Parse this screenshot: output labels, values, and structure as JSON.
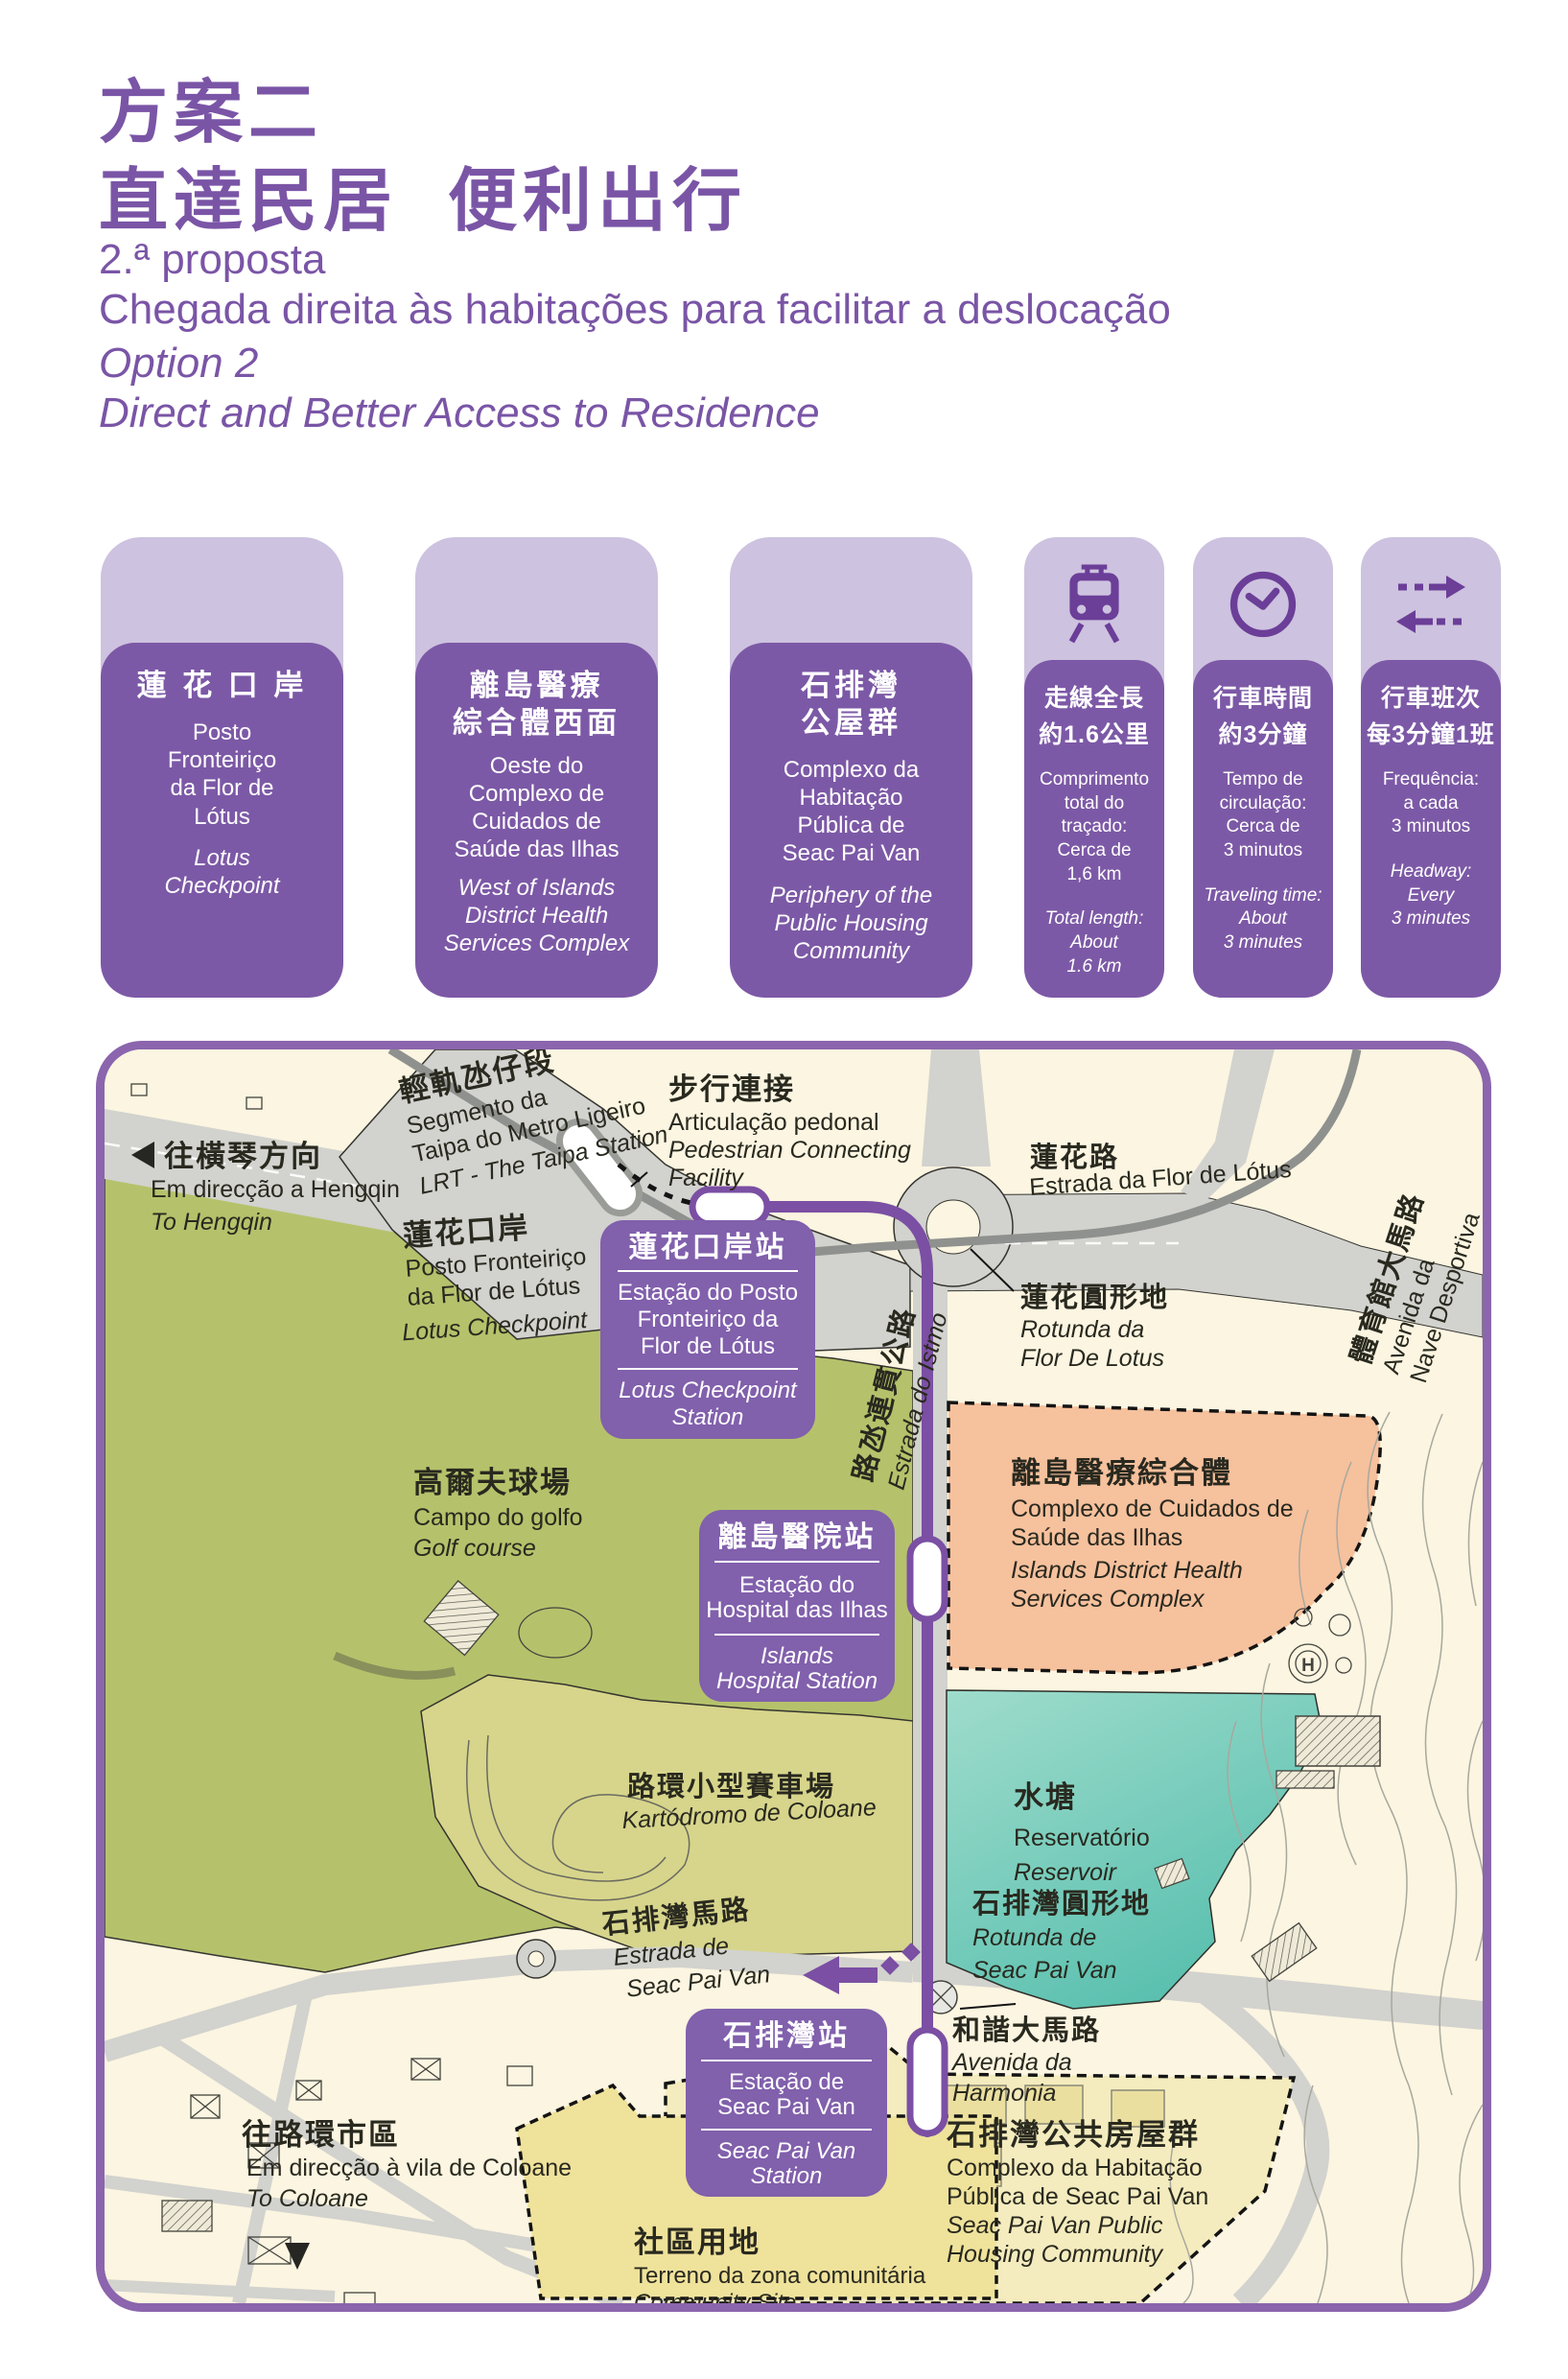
{
  "colors": {
    "accent": "#7A55A6",
    "card_light": "#CDC2DF",
    "card_dark": "#7C59A6",
    "node": "#6B3E98",
    "route": "#7B4FA3",
    "map_border": "#8B65AD",
    "map_bg": "#FBF5E1",
    "road": "#D2D2CE",
    "lrt": "#8F918E",
    "green": "#B5C26B",
    "kart": "#D7D58B",
    "orange": "#F6C19D",
    "teal": "#6FCBBB",
    "housing": "#F4ECBE",
    "community": "#EFE29B",
    "station_box": "#8160AC"
  },
  "header": {
    "title_zh_line1": "方案二",
    "title_zh_line2": "直達民居  便利出行",
    "subtitle_pt_line1": "2.ª proposta",
    "subtitle_pt_line2": "Chegada direita às habitações para facilitar a deslocação",
    "subtitle_en_line1": "Option 2",
    "subtitle_en_line2": "Direct and Better Access to Residence"
  },
  "stations": [
    {
      "zh": "蓮 花 口 岸",
      "pt": "Posto\nFronteiriço\nda Flor de\nLótus",
      "en": "Lotus\nCheckpoint"
    },
    {
      "zh": "離島醫療\n綜合體西面",
      "pt": "Oeste do\nComplexo de\nCuidados de\nSaúde das Ilhas",
      "en": "West of Islands\nDistrict Health\nServices Complex"
    },
    {
      "zh": "石排灣\n公屋群",
      "pt": "Complexo da\nHabitação\nPública de\nSeac Pai Van",
      "en": "Periphery of the\nPublic Housing\nCommunity"
    }
  ],
  "facts": [
    {
      "icon": "train-icon",
      "zh": "走線全長\n約1.6公里",
      "pt": "Comprimento\ntotal do traçado:\nCerca de\n1,6 km",
      "en": "Total length:\nAbout\n1.6 km"
    },
    {
      "icon": "clock-icon",
      "zh": "行車時間\n約3分鐘",
      "pt": "Tempo de\ncirculação:\nCerca de\n3 minutos",
      "en": "Traveling time:\nAbout\n3 minutes"
    },
    {
      "icon": "frequency-arrows-icon",
      "zh": "行車班次\n每3分鐘1班",
      "pt": "Frequência:\na cada\n3 minutos",
      "en": "Headway:\nEvery\n3 minutes"
    }
  ],
  "map": {
    "labels": {
      "direction_hengqin": {
        "zh": "往橫琴方向",
        "pt": "Em direcção a Hengqin",
        "en": "To Hengqin"
      },
      "lrt_segment": {
        "zh": "輕軌氹仔段",
        "pt": [
          "Segmento da",
          "Taipa do Metro Ligeiro"
        ],
        "en": "LRT - The Taipa Station"
      },
      "pedestrian_link": {
        "zh": "步行連接",
        "pt": "Articulação pedonal",
        "en": [
          "Pedestrian Connecting",
          "Facility"
        ]
      },
      "lotus_checkpoint": {
        "zh": "蓮花口岸",
        "pt": [
          "Posto Fronteiriço",
          "da Flor de Lótus"
        ],
        "en": "Lotus Checkpoint"
      },
      "estrada_flor_lotus": {
        "zh": "蓮花路",
        "pt": "Estrada da Flor de Lótus"
      },
      "rotunda_flor_lotus": {
        "zh": "蓮花圓形地",
        "pt": [
          "Rotunda da",
          "Flor De Lotus"
        ]
      },
      "nave_desportiva": {
        "zh": "體育館大馬路",
        "pt": [
          "Avenida da",
          "Nave Desportiva"
        ]
      },
      "estrada_istmo": {
        "zh": "路氹連貫公路",
        "pt": "Estrada do Istmo"
      },
      "health_complex": {
        "zh": "離島醫療綜合體",
        "pt": [
          "Complexo de Cuidados de",
          "Saúde das Ilhas"
        ],
        "en": [
          "Islands District Health",
          "Services Complex"
        ]
      },
      "golf": {
        "zh": "高爾夫球場",
        "pt": "Campo do golfo",
        "en": "Golf course"
      },
      "reservoir": {
        "zh": "水塘",
        "pt": "Reservatório",
        "en": "Reservoir"
      },
      "kart": {
        "zh": "路環小型賽車場",
        "pt": "Kartódromo de Coloane"
      },
      "estrada_seac_pai_van": {
        "zh": "石排灣馬路",
        "pt": [
          "Estrada de",
          "Seac Pai Van"
        ]
      },
      "rotunda_seac_pai_van": {
        "zh": "石排灣圓形地",
        "pt": [
          "Rotunda de",
          "Seac Pai Van"
        ]
      },
      "avenida_harmonia": {
        "zh": "和諧大馬路",
        "pt": [
          "Avenida da",
          "Harmonia"
        ]
      },
      "housing": {
        "zh": "石排灣公共房屋群",
        "pt": [
          "Complexo da Habitação",
          "Pública de Seac Pai Van"
        ],
        "en": [
          "Seac Pai Van Public",
          "Housing Community"
        ]
      },
      "community": {
        "zh": "社區用地",
        "pt": "Terreno da zona comunitária",
        "en": "Community Site"
      },
      "direction_coloane": {
        "zh": "往路環市區",
        "pt": "Em direcção à vila de Coloane",
        "en": "To Coloane"
      }
    },
    "station_boxes": [
      {
        "zh": "蓮花口岸站",
        "pt": [
          "Estação do Posto",
          "Fronteiriço da",
          "Flor de Lótus"
        ],
        "en": [
          "Lotus Checkpoint",
          "Station"
        ]
      },
      {
        "zh": "離島醫院站",
        "pt": [
          "Estação do",
          "Hospital das Ilhas"
        ],
        "en": [
          "Islands",
          "Hospital Station"
        ]
      },
      {
        "zh": "石排灣站",
        "pt": [
          "Estação de",
          "Seac Pai Van"
        ],
        "en": [
          "Seac Pai Van",
          "Station"
        ]
      }
    ],
    "symbols": {
      "helipad": "H"
    }
  }
}
